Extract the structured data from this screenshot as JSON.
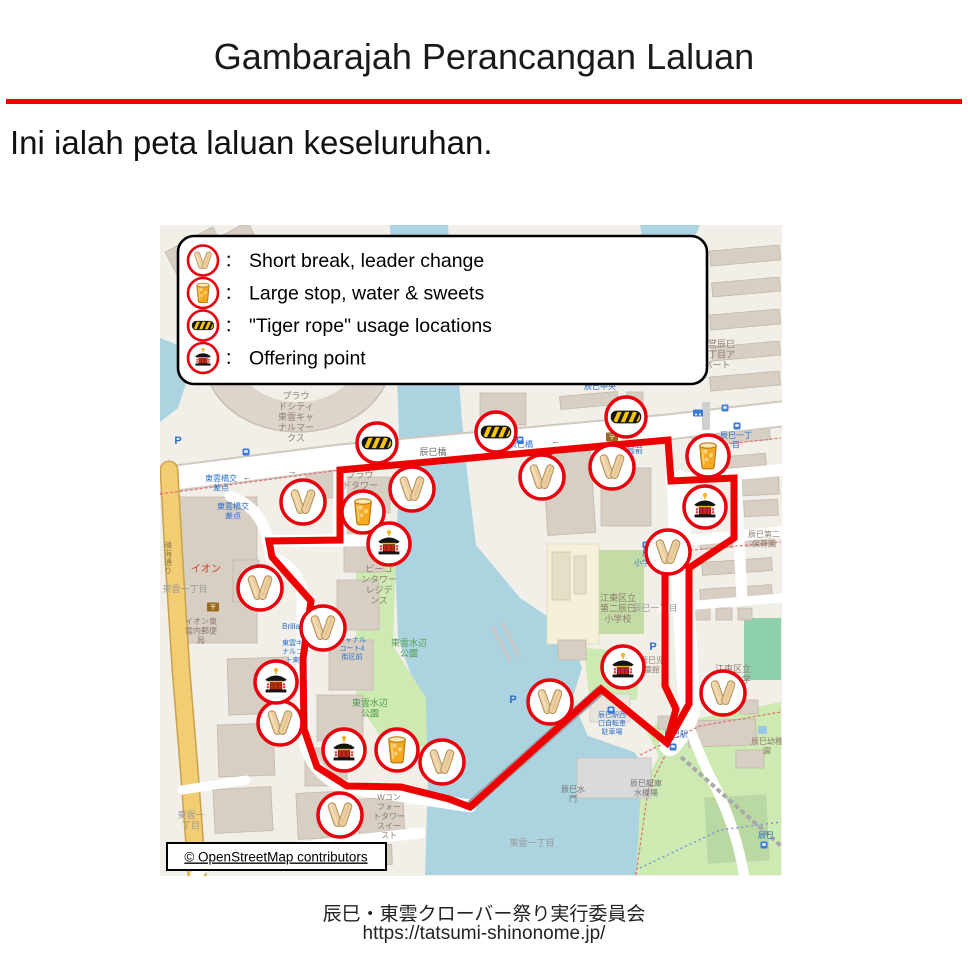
{
  "slide": {
    "title": "Gambarajah Perancangan Laluan",
    "subtitle": "Ini ialah peta laluan keseluruhan.",
    "footer_line1": "辰巳・東雲クローバー祭り実行委員会",
    "footer_line2": "https://tatsumi-shinonome.jp/",
    "accent_color": "#f40000"
  },
  "legend": {
    "separator": "：",
    "items": [
      {
        "icon": "clappers-icon",
        "symbol": "icon-clappers",
        "label": "Short break, leader change"
      },
      {
        "icon": "drink-icon",
        "symbol": "icon-drink",
        "label": "Large stop, water & sweets"
      },
      {
        "icon": "tiger-rope-icon",
        "symbol": "icon-tiger",
        "label": "\"Tiger rope\" usage locations"
      },
      {
        "icon": "offering-icon",
        "symbol": "icon-mikoshi",
        "label": "Offering point"
      }
    ]
  },
  "map": {
    "attribution": "© OpenStreetMap contributors",
    "route": {
      "color": "#ee0000",
      "width": 7,
      "loop": [
        [
          340,
          470
        ],
        [
          668,
          440
        ],
        [
          671,
          481
        ],
        [
          734,
          478
        ],
        [
          734,
          538
        ],
        [
          689,
          568
        ],
        [
          689,
          704
        ],
        [
          667,
          743
        ],
        [
          601,
          689
        ],
        [
          470,
          807
        ],
        [
          449,
          799
        ],
        [
          401,
          787
        ],
        [
          347,
          786
        ],
        [
          317,
          767
        ],
        [
          304,
          729
        ],
        [
          303,
          659
        ],
        [
          311,
          601
        ],
        [
          272,
          557
        ],
        [
          269,
          541
        ],
        [
          340,
          540
        ]
      ],
      "branch": [
        [
          665,
          574
        ],
        [
          665,
          686
        ],
        [
          676,
          709
        ],
        [
          668,
          738
        ]
      ]
    },
    "markers": [
      {
        "type": "tiger",
        "x": 377,
        "y": 443
      },
      {
        "type": "tiger",
        "x": 496,
        "y": 432
      },
      {
        "type": "tiger",
        "x": 626,
        "y": 417
      },
      {
        "type": "clappers",
        "x": 303,
        "y": 502
      },
      {
        "type": "clappers",
        "x": 412,
        "y": 489
      },
      {
        "type": "clappers",
        "x": 542,
        "y": 477
      },
      {
        "type": "clappers",
        "x": 612,
        "y": 467
      },
      {
        "type": "clappers",
        "x": 668,
        "y": 552
      },
      {
        "type": "clappers",
        "x": 260,
        "y": 588
      },
      {
        "type": "clappers",
        "x": 323,
        "y": 628
      },
      {
        "type": "clappers",
        "x": 280,
        "y": 723
      },
      {
        "type": "clappers",
        "x": 442,
        "y": 762
      },
      {
        "type": "clappers",
        "x": 340,
        "y": 815
      },
      {
        "type": "clappers",
        "x": 550,
        "y": 702
      },
      {
        "type": "clappers",
        "x": 723,
        "y": 693
      },
      {
        "type": "drink",
        "x": 363,
        "y": 512
      },
      {
        "type": "drink",
        "x": 708,
        "y": 456
      },
      {
        "type": "drink",
        "x": 397,
        "y": 750
      },
      {
        "type": "mikoshi",
        "x": 389,
        "y": 544
      },
      {
        "type": "mikoshi",
        "x": 705,
        "y": 507
      },
      {
        "type": "mikoshi",
        "x": 276,
        "y": 682
      },
      {
        "type": "mikoshi",
        "x": 344,
        "y": 750
      },
      {
        "type": "mikoshi",
        "x": 623,
        "y": 667
      }
    ],
    "labels": [
      {
        "t": "プラウ\nドシティ\n東雲キャ\nナルマー\nクス",
        "x": 296,
        "y": 399,
        "c": "#8d7d6d",
        "s": 9
      },
      {
        "t": "プラウ\nドタワー",
        "x": 360,
        "y": 478,
        "c": "#8d7d6d",
        "s": 9
      },
      {
        "t": "ビーコ\nンタワー\nレジデ\nンス",
        "x": 379,
        "y": 572,
        "c": "#8d7d6d",
        "s": 9
      },
      {
        "t": "東雲水辺\n公園",
        "x": 409,
        "y": 646,
        "c": "#4d9a4d",
        "s": 9
      },
      {
        "t": "東雲水辺\n公園",
        "x": 370,
        "y": 706,
        "c": "#4d9a4d",
        "s": 9
      },
      {
        "t": "イオン",
        "x": 206,
        "y": 572,
        "c": "#cc4125",
        "s": 10
      },
      {
        "t": "イオン東\n雲内郵便\n局",
        "x": 201,
        "y": 624,
        "c": "#8d7d6d",
        "s": 8
      },
      {
        "t": "東雲一丁目",
        "x": 185,
        "y": 592,
        "c": "#9a9a9a",
        "s": 9
      },
      {
        "t": "東雲一\n丁目",
        "x": 191,
        "y": 818,
        "c": "#9a9a9a",
        "s": 9
      },
      {
        "t": "東雲一丁目",
        "x": 532,
        "y": 846,
        "c": "#9a9a9a",
        "s": 9
      },
      {
        "t": "辰巳橋",
        "x": 433,
        "y": 455,
        "c": "#666666",
        "s": 9
      },
      {
        "t": "晴海通り",
        "x": 168,
        "y": 548,
        "c": "#8d7d42",
        "s": 8,
        "v": true
      },
      {
        "t": "都営辰巳\n一丁目ア\nパート",
        "x": 717,
        "y": 347,
        "c": "#8d7d6d",
        "s": 9
      },
      {
        "t": "辰巳第二\n保育園",
        "x": 764,
        "y": 537,
        "c": "#8d7d6d",
        "s": 8
      },
      {
        "t": "江東区立\n第二辰巳\n小学校",
        "x": 618,
        "y": 601,
        "c": "#8d7d6d",
        "s": 9
      },
      {
        "t": "辰巳一丁目",
        "x": 655,
        "y": 611,
        "c": "#9a9a9a",
        "s": 9
      },
      {
        "t": "江東区立\n辰巳小学\n校",
        "x": 733,
        "y": 672,
        "c": "#8d7d6d",
        "s": 9
      },
      {
        "t": "辰巳幼稚\n園",
        "x": 767,
        "y": 744,
        "c": "#8d7d6d",
        "s": 8
      },
      {
        "t": "辰巳水\n門",
        "x": 573,
        "y": 792,
        "c": "#777777",
        "s": 8
      },
      {
        "t": "辰巳艇庫\n水機場",
        "x": 646,
        "y": 786,
        "c": "#777777",
        "s": 8
      },
      {
        "t": "Wコン\nフォー\nトタワー\nスイー\nスト",
        "x": 389,
        "y": 800,
        "c": "#8d7d6d",
        "s": 8
      },
      {
        "t": "辰巳児\n童館",
        "x": 652,
        "y": 663,
        "c": "#8d7d6d",
        "s": 8
      },
      {
        "t": "東雲橋交\n差点",
        "x": 221,
        "y": 481,
        "c": "#2a6fc9",
        "s": 8
      },
      {
        "t": "東雲橋交\n差点",
        "x": 233,
        "y": 509,
        "c": "#2a6fc9",
        "s": 8
      },
      {
        "t": "辰巳橋",
        "x": 521,
        "y": 447,
        "c": "#2a6fc9",
        "s": 8
      },
      {
        "t": "便局前",
        "x": 631,
        "y": 453,
        "c": "#2a6fc9",
        "s": 8
      },
      {
        "t": "辰巳一丁\n目",
        "x": 736,
        "y": 438,
        "c": "#2a6fc9",
        "s": 8
      },
      {
        "t": "辰巳中央",
        "x": 600,
        "y": 389,
        "c": "#2a6fc9",
        "s": 8
      },
      {
        "t": "辰巳\n小学校前",
        "x": 650,
        "y": 556,
        "c": "#2a6fc9",
        "s": 8
      },
      {
        "t": "辰巳駅",
        "x": 676,
        "y": 737,
        "c": "#2a6fc9",
        "s": 8
      },
      {
        "t": "辰巳駅西\n口自転車\n駐車場",
        "x": 612,
        "y": 717,
        "c": "#2a6fc9",
        "s": 7
      },
      {
        "t": "辰巳",
        "x": 766,
        "y": 838,
        "c": "#2a6fc9",
        "s": 8
      },
      {
        "t": "Brilla",
        "x": 291,
        "y": 629,
        "c": "#2a6fc9",
        "s": 8
      },
      {
        "t": "東雲キャ\nナルコー\nト東側",
        "x": 296,
        "y": 645,
        "c": "#2a6fc9",
        "s": 7
      },
      {
        "t": "キャナル\nコート4\n街区前",
        "x": 352,
        "y": 642,
        "c": "#2a6fc9",
        "s": 7
      }
    ],
    "pois": [
      {
        "icon": "parking",
        "x": 178,
        "y": 440
      },
      {
        "icon": "parking",
        "x": 205,
        "y": 320
      },
      {
        "icon": "parking",
        "x": 513,
        "y": 699
      },
      {
        "icon": "parking",
        "x": 653,
        "y": 646
      },
      {
        "icon": "post-office",
        "x": 213,
        "y": 607
      },
      {
        "icon": "post-office",
        "x": 612,
        "y": 437
      },
      {
        "icon": "bus-stop",
        "x": 246,
        "y": 452
      },
      {
        "icon": "bus-stop",
        "x": 520,
        "y": 440
      },
      {
        "icon": "bus-stop",
        "x": 549,
        "y": 452
      },
      {
        "icon": "bus-stop",
        "x": 617,
        "y": 431
      },
      {
        "icon": "bus-stop",
        "x": 725,
        "y": 408
      },
      {
        "icon": "bus-stop",
        "x": 737,
        "y": 426
      },
      {
        "icon": "bus-stop",
        "x": 646,
        "y": 545
      },
      {
        "icon": "bus-stop",
        "x": 611,
        "y": 710
      },
      {
        "icon": "bus-stop",
        "x": 673,
        "y": 747
      },
      {
        "icon": "bus-stop",
        "x": 764,
        "y": 845
      },
      {
        "icon": "taxi",
        "x": 698,
        "y": 413
      },
      {
        "icon": "arrow-left",
        "x": 247,
        "y": 477
      },
      {
        "icon": "arrow-right",
        "x": 292,
        "y": 471
      },
      {
        "icon": "arrow-left",
        "x": 556,
        "y": 441
      },
      {
        "icon": "arrow-right",
        "x": 610,
        "y": 434
      }
    ]
  }
}
